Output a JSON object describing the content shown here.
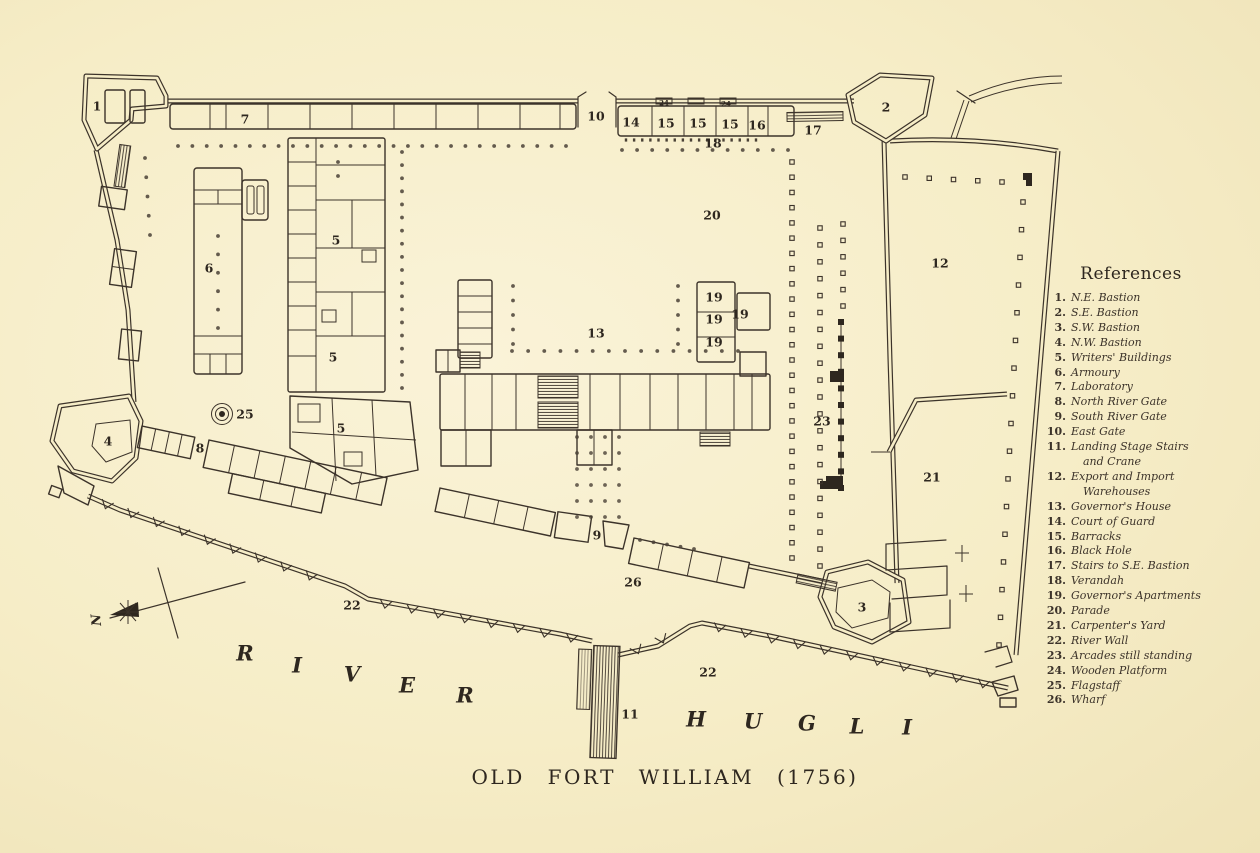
{
  "title": "OLD FORT WILLIAM (1756)",
  "river_labels": {
    "river": "RIVER",
    "hugli": "HUGLI"
  },
  "compass": {
    "label": "N"
  },
  "references": {
    "heading": "References",
    "items": [
      {
        "num": "1.",
        "label": "N.E. Bastion"
      },
      {
        "num": "2.",
        "label": "S.E. Bastion"
      },
      {
        "num": "3.",
        "label": "S.W. Bastion"
      },
      {
        "num": "4.",
        "label": "N.W. Bastion"
      },
      {
        "num": "5.",
        "label": "Writers' Buildings"
      },
      {
        "num": "6.",
        "label": "Armoury"
      },
      {
        "num": "7.",
        "label": "Laboratory"
      },
      {
        "num": "8.",
        "label": "North River Gate"
      },
      {
        "num": "9.",
        "label": "South River Gate"
      },
      {
        "num": "10.",
        "label": "East Gate"
      },
      {
        "num": "11.",
        "label": "Landing Stage Stairs",
        "label2": "and Crane"
      },
      {
        "num": "12.",
        "label": "Export and Import",
        "label2": "Warehouses"
      },
      {
        "num": "13.",
        "label": "Governor's House"
      },
      {
        "num": "14.",
        "label": "Court of Guard"
      },
      {
        "num": "15.",
        "label": "Barracks"
      },
      {
        "num": "16.",
        "label": "Black Hole"
      },
      {
        "num": "17.",
        "label": "Stairs to S.E. Bastion"
      },
      {
        "num": "18.",
        "label": "Verandah"
      },
      {
        "num": "19.",
        "label": "Governor's Apartments"
      },
      {
        "num": "20.",
        "label": "Parade"
      },
      {
        "num": "21.",
        "label": "Carpenter's Yard"
      },
      {
        "num": "22.",
        "label": "River Wall"
      },
      {
        "num": "23.",
        "label": "Arcades still standing"
      },
      {
        "num": "24.",
        "label": "Wooden Platform"
      },
      {
        "num": "25.",
        "label": "Flagstaff"
      },
      {
        "num": "26.",
        "label": "Wharf"
      }
    ]
  },
  "map_labels": [
    {
      "t": "1",
      "x": 97,
      "y": 106
    },
    {
      "t": "7",
      "x": 245,
      "y": 119
    },
    {
      "t": "10",
      "x": 596,
      "y": 116
    },
    {
      "t": "14",
      "x": 631,
      "y": 122
    },
    {
      "t": "15",
      "x": 666,
      "y": 123
    },
    {
      "t": "15",
      "x": 698,
      "y": 123
    },
    {
      "t": "15",
      "x": 730,
      "y": 124
    },
    {
      "t": "16",
      "x": 757,
      "y": 125
    },
    {
      "t": "24",
      "x": 664,
      "y": 103,
      "s": 7
    },
    {
      "t": "24",
      "x": 726,
      "y": 104,
      "s": 7
    },
    {
      "t": "17",
      "x": 813,
      "y": 130
    },
    {
      "t": "2",
      "x": 886,
      "y": 107
    },
    {
      "t": "18",
      "x": 713,
      "y": 143
    },
    {
      "t": "20",
      "x": 712,
      "y": 215
    },
    {
      "t": "12",
      "x": 940,
      "y": 263
    },
    {
      "t": "6",
      "x": 209,
      "y": 268
    },
    {
      "t": "5",
      "x": 336,
      "y": 240
    },
    {
      "t": "5",
      "x": 333,
      "y": 357
    },
    {
      "t": "5",
      "x": 341,
      "y": 428
    },
    {
      "t": "19",
      "x": 714,
      "y": 297
    },
    {
      "t": "19",
      "x": 714,
      "y": 319
    },
    {
      "t": "19",
      "x": 740,
      "y": 314
    },
    {
      "t": "19",
      "x": 714,
      "y": 342
    },
    {
      "t": "13",
      "x": 596,
      "y": 333
    },
    {
      "t": "23",
      "x": 822,
      "y": 421
    },
    {
      "t": "25",
      "x": 245,
      "y": 414
    },
    {
      "t": "4",
      "x": 108,
      "y": 441
    },
    {
      "t": "8",
      "x": 200,
      "y": 448
    },
    {
      "t": "21",
      "x": 932,
      "y": 477
    },
    {
      "t": "9",
      "x": 597,
      "y": 535
    },
    {
      "t": "26",
      "x": 633,
      "y": 582
    },
    {
      "t": "3",
      "x": 862,
      "y": 607
    },
    {
      "t": "22",
      "x": 352,
      "y": 605
    },
    {
      "t": "22",
      "x": 708,
      "y": 672
    },
    {
      "t": "11",
      "x": 630,
      "y": 714
    }
  ],
  "colors": {
    "paper": "#f6edc7",
    "ink": "#3c332a"
  }
}
